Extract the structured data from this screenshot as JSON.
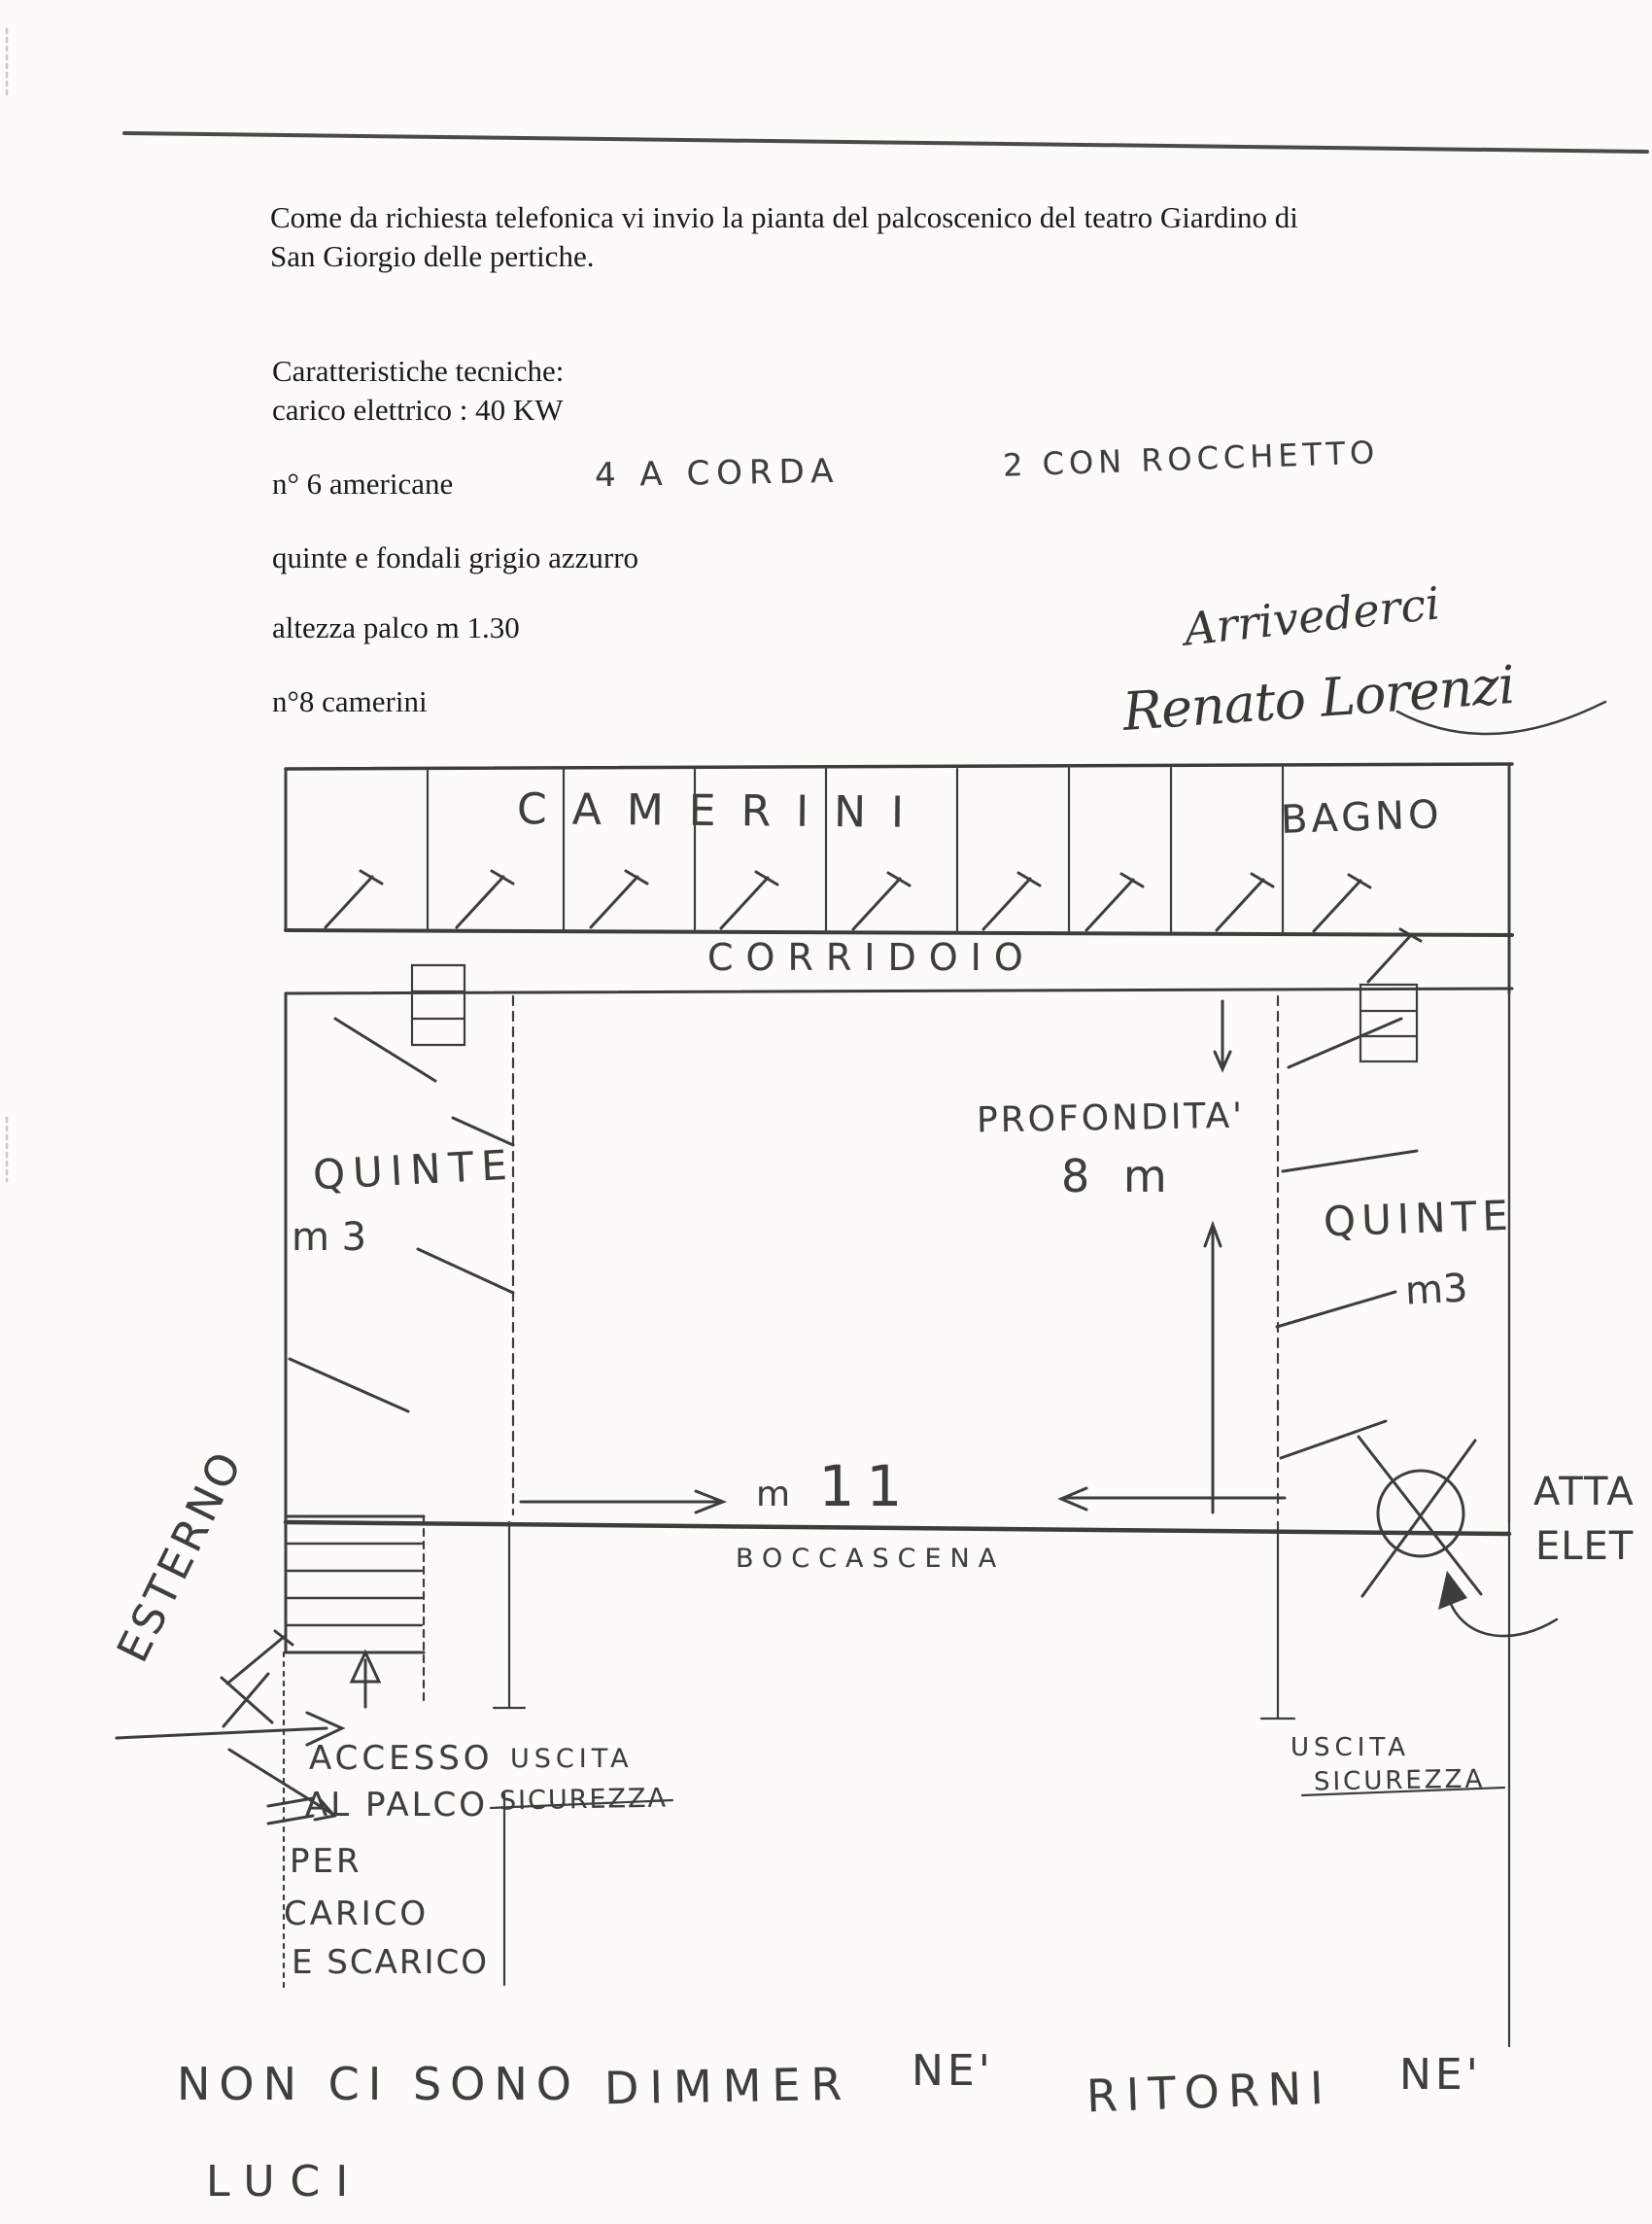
{
  "letter": {
    "line1": "Come da richiesta telefonica vi invio la pianta del palcoscenico del teatro Giardino di",
    "line2": "San Giorgio delle pertiche.",
    "specs_title": "Caratteristiche tecniche:",
    "spec_carico": "carico elettrico  : 40 KW",
    "spec_americane": "n° 6  americane",
    "hand_corda": "4  A CORDA",
    "hand_rocchetto": "2  CON ROCCHETTO",
    "spec_quinte": "quinte e fondali  grigio azzurro",
    "spec_altezza": "altezza palco m 1.30",
    "spec_camerini": "n°8  camerini",
    "closing_hand": "Arrivederci",
    "signature_hand": "Renato Lorenzi"
  },
  "plan": {
    "camerini": "CAMERINI",
    "bagno": "BAGNO",
    "corridoio": "CORRIDOIO",
    "quinte_left": "QUINTE",
    "quinte_left_m": "m 3",
    "quinte_right": "QUINTE",
    "quinte_right_m": "m3",
    "profondita": "PROFONDITA'",
    "profondita_m": "8 m",
    "larghezza_prefix": "m",
    "larghezza_value": "11",
    "boccascena": "BOCCASCENA",
    "esterno": "ESTERNO",
    "accesso": [
      "ACCESSO",
      "AL PALCO",
      "PER",
      "CARICO",
      "E SCARICO"
    ],
    "uscita_left": [
      "USCITA",
      "SICUREZZA"
    ],
    "uscita_right": [
      "USCITA",
      "SICUREZZA"
    ],
    "attacco": [
      "ATTA",
      "ELET"
    ],
    "nota_fondo": [
      "NON CI SONO",
      "DIMMER",
      "NE'",
      "RITORNI",
      "NE'",
      "LUCI"
    ]
  }
}
